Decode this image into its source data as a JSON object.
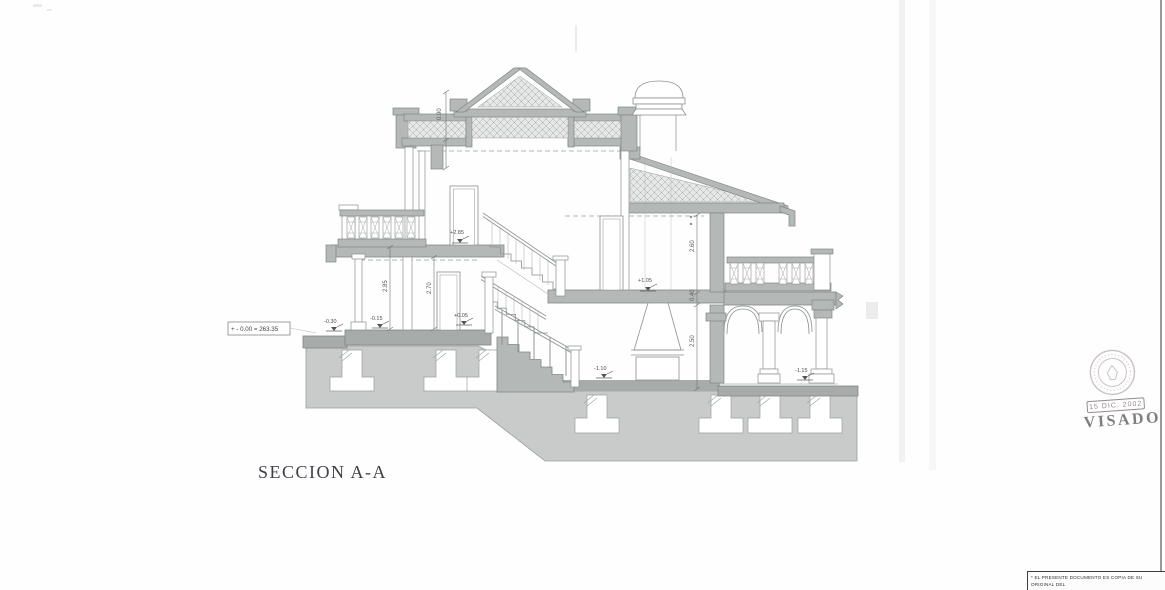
{
  "drawing": {
    "title": "SECCION A-A",
    "reference_level": "+ - 0.00 = 263.35",
    "elevation_markers": {
      "upper_floor": "+2.85",
      "mid_landing": "+1.05",
      "entry": "+0.05",
      "terrace_step": "-0.15",
      "terrace_low": "-0.30",
      "basement_left": "-1.10",
      "basement_right": "-1.15"
    },
    "dimensions": {
      "parapet": "0.90",
      "floor_left": "2.85",
      "clear_left": "2.70",
      "right_upper": "2.60",
      "right_slab": "0.40",
      "right_clear": "2.50"
    }
  },
  "stamp": {
    "date": "15 DIC. 2002",
    "label": "VISADO"
  },
  "note": {
    "line1": "* EL PRESENTE DOCUMENTO ES COPIA DE SU ORIGINAL DEL",
    "line2": "QUE ES AUTOR EL ARQUITECTO, A LOS EFECTOS OPORTUNOS"
  },
  "colors": {
    "cut_wall": "#b4b8b7",
    "foundation": "#c8cbca",
    "slab": "#a7abaa",
    "line": "#8b908e",
    "stamp_ink": "#8d8080"
  }
}
